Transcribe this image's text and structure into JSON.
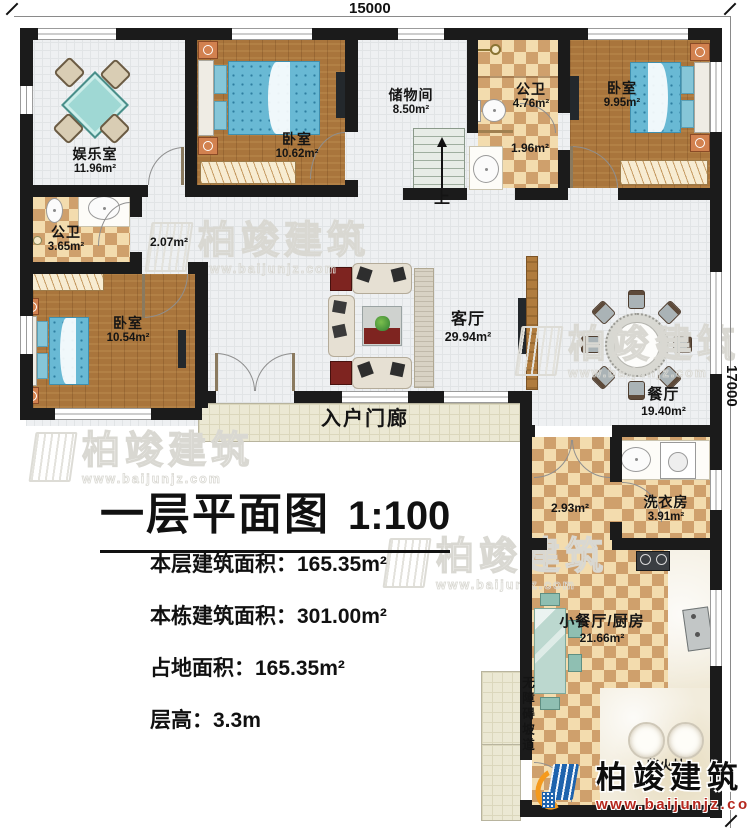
{
  "dims": {
    "top": "15000",
    "right": "17000"
  },
  "rooms": {
    "yuleshi": {
      "name": "娱乐室",
      "area": "11.96m²"
    },
    "woshi1": {
      "name": "卧室",
      "area": "10.62m²"
    },
    "chuwujian": {
      "name": "储物间",
      "area": "8.50m²"
    },
    "gongwei_top": {
      "name": "公卫",
      "area": "4.76m²"
    },
    "woshi2": {
      "name": "卧室",
      "area": "9.95m²"
    },
    "xishou_nook": {
      "area": "1.96m²"
    },
    "gongwei_left": {
      "name": "公卫",
      "area": "3.65m²"
    },
    "guodao": {
      "area": "2.07m²"
    },
    "woshi3": {
      "name": "卧室",
      "area": "10.54m²"
    },
    "keting": {
      "name": "客厅",
      "area": "29.94m²"
    },
    "canting": {
      "name": "餐厅",
      "area": "19.40m²"
    },
    "porch": {
      "name": "入户门廊"
    },
    "hallway": {
      "area": "2.93m²"
    },
    "xiyifang": {
      "name": "洗衣房",
      "area": "3.91m²"
    },
    "kitchen": {
      "name": "小餐厅/厨房",
      "area": "21.66m²"
    },
    "ramp": {
      "name": "无障碍坡道"
    },
    "chaihuozao": {
      "name": "柴火灶"
    },
    "stairs": {
      "up_label": "上"
    }
  },
  "title": {
    "main": "一层平面图",
    "scale": "1:100"
  },
  "stats": [
    "本层建筑面积：165.35m²",
    "本栋建筑面积：301.00m²",
    "占地面积：165.35m²",
    "层高：3.3m"
  ],
  "branding": {
    "name": "柏竣建筑",
    "url": "www.baijunjz.com"
  },
  "watermark": {
    "name": "柏竣建筑",
    "url": "www.baijunjz.com"
  },
  "colors": {
    "wall": "#1b1b1b",
    "wood_floor": "#a9753c",
    "checker_light": "#f3dcae",
    "checker_dark": "#cfa06c",
    "bed_blue": "#69b9d4",
    "logo_blue": "#1e63ad",
    "logo_orange": "#f59a1d",
    "url_red": "#b5271d"
  }
}
